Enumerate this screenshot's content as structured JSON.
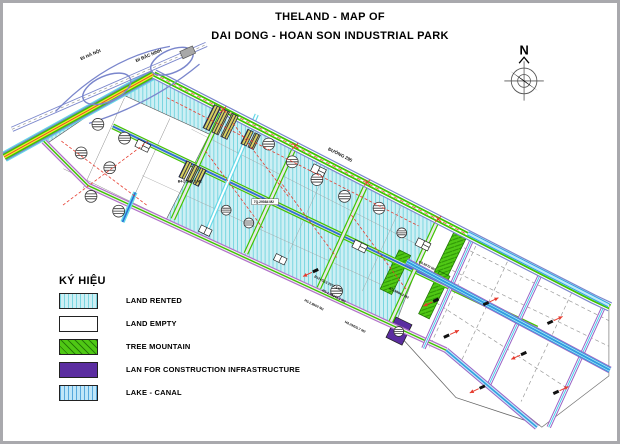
{
  "title": {
    "line1": "THELAND - MAP OF",
    "line2": "DAI DONG - HOAN SON INDUSTRIAL PARK"
  },
  "compass": {
    "label": "N"
  },
  "legend": {
    "title": "KÝ HIỆU",
    "items": [
      {
        "label": "LAND RENTED"
      },
      {
        "label": "LAND EMPTY"
      },
      {
        "label": "TREE MOUNTAIN"
      },
      {
        "label": "LAN FOR CONSTRUCTION INFRASTRUCTURE"
      },
      {
        "label": "LAKE - CANAL"
      }
    ]
  },
  "map": {
    "road_labels": [
      {
        "text": "ĐI HÀ NỘI"
      },
      {
        "text": "ĐI BẮC NINH"
      },
      {
        "text": "ĐƯỜNG 295"
      }
    ],
    "parcel_labels": [
      {
        "text": "B4-2 1997.2 M2"
      },
      {
        "text": "7Q.29084 M2"
      },
      {
        "text": "B12+G13 2977.8 M2"
      },
      {
        "text": "H3-1.13343.3 M2"
      },
      {
        "text": "H3-2.8600 M2"
      },
      {
        "text": "KD.5994.3 M2"
      },
      {
        "text": "C0.5070 M2"
      },
      {
        "text": "H4.29425.7 M2"
      }
    ],
    "colors": {
      "land_rented_fill": "#cdeff4",
      "land_rented_hatch": "#79d6e0",
      "land_empty": "#ffffff",
      "tree_mountain": "#4fc814",
      "construction_infrastructure": "#5b2da0",
      "lake_canal_fill": "#bfe6f8",
      "lake_canal_hatch": "#56a8dc",
      "road_green": "#3fc400",
      "road_purple": "#9a63c4",
      "highway_blue": "#7a86cc",
      "boundary_red": "#e63b2e",
      "stripe_yellow": "#f0ec2c"
    }
  }
}
